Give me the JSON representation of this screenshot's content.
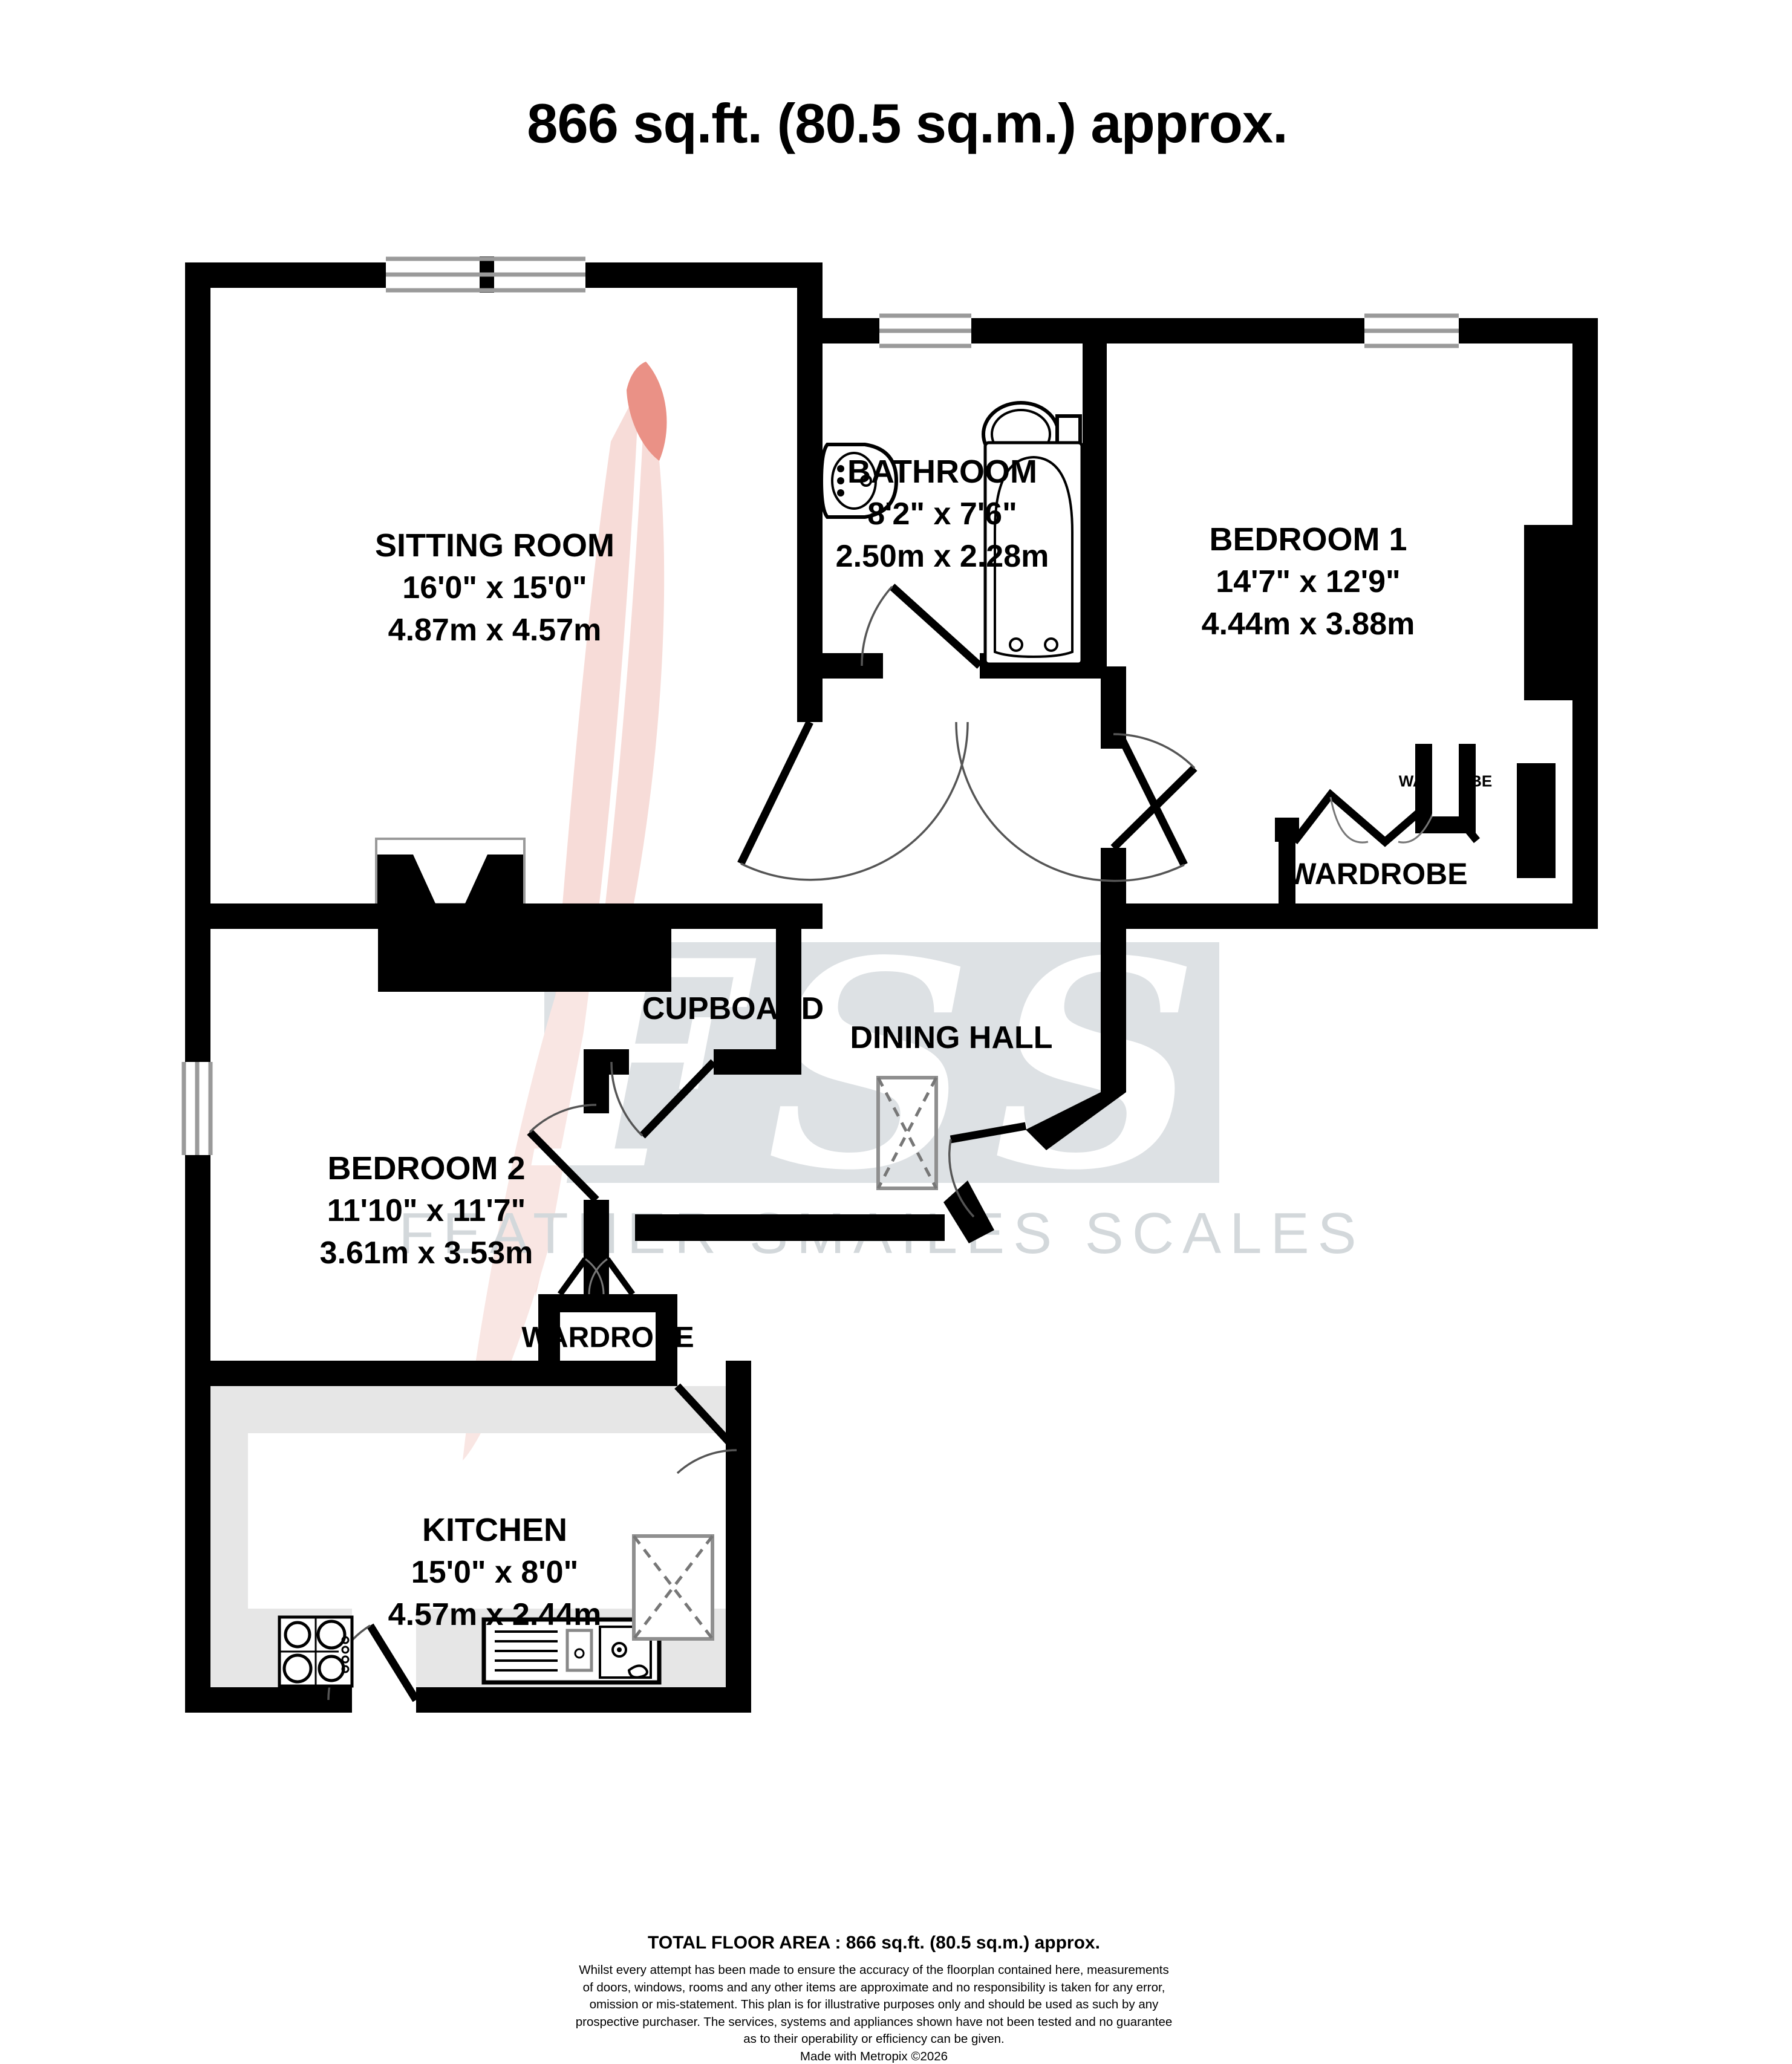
{
  "title": "866 sq.ft. (80.5 sq.m.) approx.",
  "rooms": {
    "sitting_room": {
      "name": "SITTING ROOM",
      "imperial": "16'0\"  x 15'0\"",
      "metric": "4.87m  x 4.57m"
    },
    "bathroom": {
      "name": "BATHROOM",
      "imperial": "8'2\"  x 7'6\"",
      "metric": "2.50m  x 2.28m"
    },
    "bedroom1": {
      "name": "BEDROOM 1",
      "imperial": "14'7\"  x 12'9\"",
      "metric": "4.44m  x 3.88m"
    },
    "bedroom2": {
      "name": "BEDROOM 2",
      "imperial": "11'10\"  x 11'7\"",
      "metric": "3.61m  x 3.53m"
    },
    "kitchen": {
      "name": "KITCHEN",
      "imperial": "15'0\"  x 8'0\"",
      "metric": "4.57m  x 2.44m"
    },
    "dining_hall": {
      "name": "DINING HALL"
    },
    "cupboard": {
      "name": "CUPBOARD"
    },
    "wardrobe_bedroom1": {
      "name": "WARDROBE"
    },
    "wardrobe_bedroom2": {
      "name": "WARDROBE"
    },
    "wardrobe_closet": {
      "name": "WARDROBE"
    }
  },
  "watermark": {
    "fss": "FSS",
    "tagline": "FEATHER SMAILES SCALES"
  },
  "footer": {
    "total": "TOTAL FLOOR AREA : 866 sq.ft. (80.5 sq.m.) approx.",
    "disclaimer_lines": [
      "Whilst every attempt has been made to ensure the accuracy of the floorplan contained here, measurements",
      "of doors, windows, rooms and any other items are approximate and no responsibility is taken for any error,",
      "omission or mis-statement. This plan is for illustrative purposes only and should be used as such by any",
      "prospective purchaser. The services, systems and appliances shown have not been tested and no guarantee",
      "as to their operability or efficiency can be given."
    ],
    "credit": "Made with Metropix ©2026"
  },
  "colors": {
    "wall": "#000000",
    "counter": "#e6e6e6",
    "watermark_panel": "#dde1e4",
    "watermark_text": "#d3d8db",
    "feather_body": "#f7dcd8",
    "feather_tip": "#ea9186",
    "fixture_outline": "#8f8f8f"
  }
}
